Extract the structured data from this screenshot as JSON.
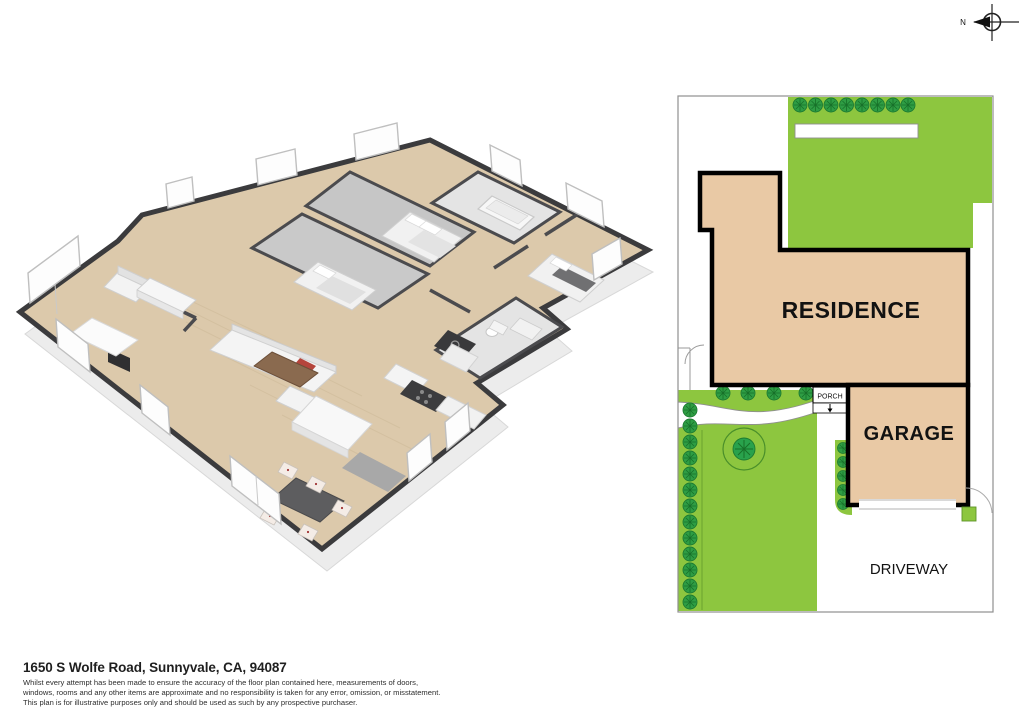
{
  "compass": {
    "north_label": "N"
  },
  "site_plan": {
    "residence_label": "RESIDENCE",
    "garage_label": "GARAGE",
    "porch_label": "PORCH",
    "driveway_label": "DRIVEWAY",
    "colors": {
      "lawn": "#8dc63f",
      "bush": "#2e9d44",
      "building_fill": "#e9c9a5",
      "building_outline": "#000000",
      "lot_border": "#8f8f8f"
    }
  },
  "floor_plan": {
    "colors": {
      "wood_floor": "#dcc9ab",
      "carpet": "#c6c6c6",
      "tile": "#e4e4e4",
      "wall_top": "#3b3b3d",
      "wall_face": "#f3f3f3"
    }
  },
  "footer": {
    "address": "1650 S Wolfe Road, Sunnyvale, CA, 94087",
    "disclaimer_lines": [
      "Whilst every attempt has been made to ensure the accuracy of the floor plan contained here, measurements of doors,",
      "windows, rooms and any other items are approximate and no responsibility is taken for any error, omission, or misstatement.",
      "This plan is for illustrative purposes only and should be used as such by any prospective purchaser."
    ]
  }
}
